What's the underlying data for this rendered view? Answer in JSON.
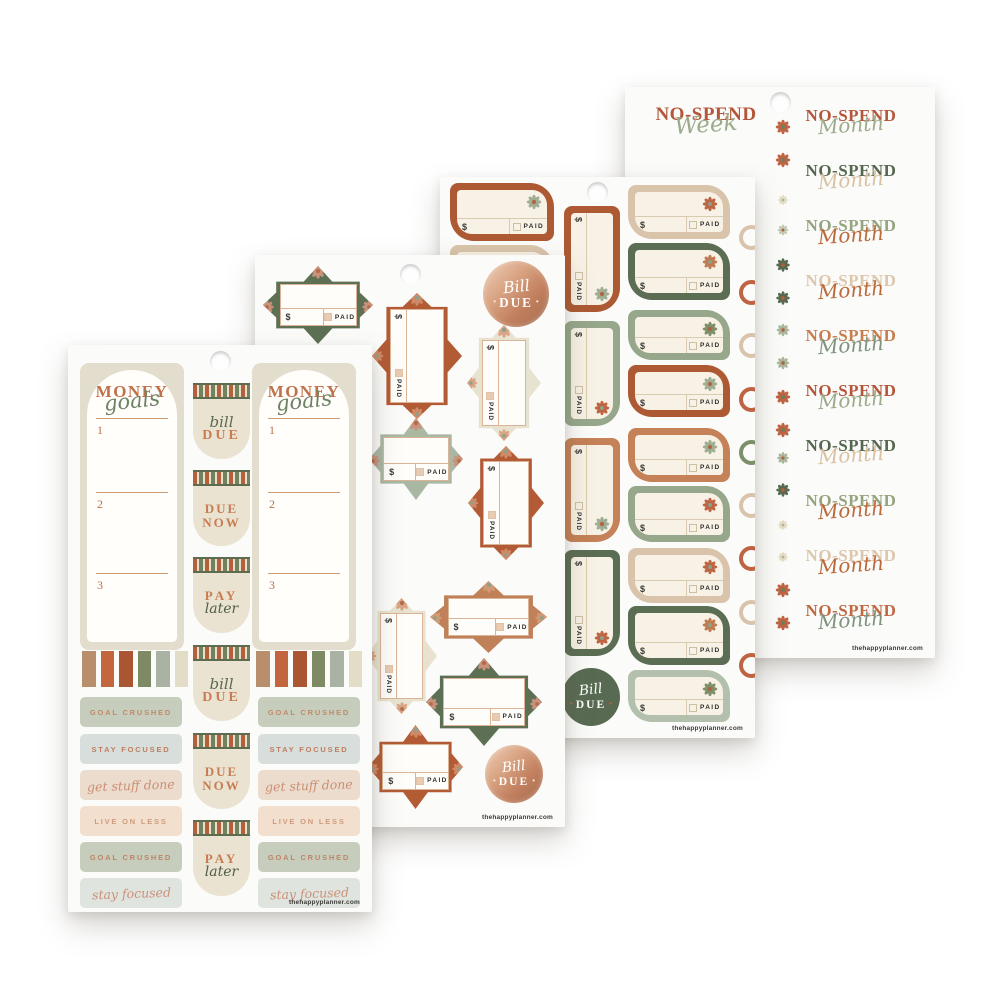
{
  "shared": {
    "website": "thehappyplanner.com",
    "dollar": "$",
    "paid": "PAID",
    "dot": "•"
  },
  "sheet1": {
    "money_sticker": {
      "title": "MONEY",
      "title_script": "goals",
      "sections": [
        "1",
        "2",
        "3"
      ],
      "title_color": "#c0714a",
      "script_color": "#6e8264",
      "num_color": "#bf6f4a"
    },
    "washi_colors": [
      "#b98e6d",
      "#c4663d",
      "#ab5632",
      "#7d8a63",
      "#aab3a3",
      "#e3ddc8"
    ],
    "tabs": [
      {
        "style": "bill-due",
        "line1": "bill",
        "line2": "DUE"
      },
      {
        "style": "due-now",
        "line1": "DUE",
        "line2": "NOW"
      },
      {
        "style": "pay-later",
        "line1": "PAY",
        "line2": "later"
      },
      {
        "style": "bill-due",
        "line1": "bill",
        "line2": "DUE"
      },
      {
        "style": "due-now",
        "line1": "DUE",
        "line2": "NOW"
      },
      {
        "style": "pay-later",
        "line1": "PAY",
        "line2": "later"
      }
    ],
    "tab_colors": {
      "script_green": "#5a6a52",
      "rust": "#c97c52",
      "dark_green": "#4f5d49"
    },
    "labels": [
      {
        "text": "GOAL CRUSHED",
        "bg": "#c7cdbc",
        "color": "#c08a68",
        "script": false
      },
      {
        "text": "STAY FOCUSED",
        "bg": "#d7dedb",
        "color": "#c17d5f",
        "script": false
      },
      {
        "text": "get stuff done",
        "bg": "#ecdccd",
        "color": "#ca8f74",
        "script": true
      },
      {
        "text": "LIVE ON LESS",
        "bg": "#f3dfcd",
        "color": "#cf9b7d",
        "script": false
      },
      {
        "text": "GOAL CRUSHED",
        "bg": "#c7cdbc",
        "color": "#bd8566",
        "script": false
      },
      {
        "text": "stay focused",
        "bg": "#dfe4de",
        "color": "#cb9179",
        "script": true
      }
    ]
  },
  "sheet2": {
    "tags": [
      {
        "type": "h",
        "x": 8,
        "y": 11,
        "w": 110,
        "h": 78,
        "color": "#5d7054",
        "petal": "#c9927a",
        "center": "#b56a4a"
      },
      {
        "type": "v",
        "x": 117,
        "y": 38,
        "w": 90,
        "h": 126,
        "color": "#b25b35",
        "petal": "#cf8a68",
        "center": "#8fa08a"
      },
      {
        "type": "v",
        "x": 212,
        "y": 70,
        "w": 74,
        "h": 116,
        "color": "#e8e2d0",
        "petal": "#d9a585",
        "center": "#8fa08a"
      },
      {
        "type": "h",
        "x": 114,
        "y": 163,
        "w": 94,
        "h": 82,
        "color": "#a9b7a3",
        "petal": "#c9927a",
        "center": "#b56a4a"
      },
      {
        "type": "v",
        "x": 213,
        "y": 191,
        "w": 76,
        "h": 114,
        "color": "#b25b35",
        "petal": "#cf8a68",
        "center": "#8fa08a"
      },
      {
        "type": "h",
        "x": 175,
        "y": 326,
        "w": 117,
        "h": 72,
        "color": "#c08159",
        "petal": "#d19a77",
        "center": "#8fa08a"
      },
      {
        "type": "v",
        "x": 111,
        "y": 343,
        "w": 71,
        "h": 116,
        "color": "#e8e2d0",
        "petal": "#d9a585",
        "center": "#b56a4a"
      },
      {
        "type": "h",
        "x": 171,
        "y": 403,
        "w": 116,
        "h": 88,
        "color": "#5d7054",
        "petal": "#c9927a",
        "center": "#b56a4a"
      },
      {
        "type": "h",
        "x": 113,
        "y": 470,
        "w": 95,
        "h": 84,
        "color": "#b25b35",
        "petal": "#cf8a68",
        "center": "#8fa08a"
      }
    ],
    "circles": [
      {
        "x": 228,
        "y": 6,
        "d": 66
      },
      {
        "x": 230,
        "y": 490,
        "d": 58
      }
    ],
    "circle_text": {
      "script": "Bill",
      "word": "DUE"
    }
  },
  "sheet3": {
    "left_tags": [
      {
        "y": 6,
        "h": 58,
        "color": "#ad5a34",
        "flower": "#9fae93",
        "fcenter": "#b5603c"
      },
      {
        "y": 68,
        "h": 55,
        "color": "#d9c4ab",
        "flower": "#bf6442",
        "fcenter": "#8fa08a"
      }
    ],
    "mid_tags": [
      {
        "y": 29,
        "h": 106,
        "color": "#ad5a34",
        "flower": "#9fae93",
        "fcenter": "#b5603c"
      },
      {
        "y": 144,
        "h": 105,
        "color": "#97a78b",
        "flower": "#bf6442",
        "fcenter": "#8fa08a"
      },
      {
        "y": 261,
        "h": 104,
        "color": "#c58157",
        "flower": "#9fae93",
        "fcenter": "#b5603c"
      },
      {
        "y": 373,
        "h": 106,
        "color": "#5b6d53",
        "flower": "#bf6442",
        "fcenter": "#8fa08a"
      }
    ],
    "right_tags": [
      {
        "y": 8,
        "h": 54,
        "color": "#d9c4ab",
        "flower": "#bf6442",
        "fcenter": "#8fa08a"
      },
      {
        "y": 66,
        "h": 57,
        "color": "#5b6d53",
        "flower": "#c07a50",
        "fcenter": "#8fa08a"
      },
      {
        "y": 133,
        "h": 50,
        "color": "#97a78b",
        "flower": "#7d8f68",
        "fcenter": "#b5603c"
      },
      {
        "y": 188,
        "h": 52,
        "color": "#ad5a34",
        "flower": "#9fae93",
        "fcenter": "#b5603c"
      },
      {
        "y": 251,
        "h": 54,
        "color": "#c58157",
        "flower": "#9fae93",
        "fcenter": "#b5603c"
      },
      {
        "y": 309,
        "h": 56,
        "color": "#97a78b",
        "flower": "#bf6442",
        "fcenter": "#8fa08a"
      },
      {
        "y": 371,
        "h": 55,
        "color": "#d9c4ab",
        "flower": "#bf6442",
        "fcenter": "#8fa08a"
      },
      {
        "y": 429,
        "h": 59,
        "color": "#5b6d53",
        "flower": "#c07a50",
        "fcenter": "#8fa08a"
      },
      {
        "y": 493,
        "h": 52,
        "color": "#b3c0ad",
        "flower": "#7d8f68",
        "fcenter": "#b5603c"
      }
    ],
    "rings": [
      {
        "y": 48,
        "color": "#d9c4ab"
      },
      {
        "y": 103,
        "color": "#bf6442"
      },
      {
        "y": 156,
        "color": "#d9c4ab"
      },
      {
        "y": 210,
        "color": "#bf6442"
      },
      {
        "y": 263,
        "color": "#7d8f68"
      },
      {
        "y": 316,
        "color": "#d9c4ab"
      },
      {
        "y": 369,
        "color": "#bf6442"
      },
      {
        "y": 423,
        "color": "#d9c4ab"
      },
      {
        "y": 476,
        "color": "#bf6442"
      }
    ],
    "circle": {
      "x": 122,
      "y": 491,
      "d": 58
    },
    "circle_text": {
      "script": "Bill",
      "word": "DUE"
    }
  },
  "sheet4": {
    "week_row": {
      "word": "NO-SPEND",
      "script": "Week",
      "word_color": "#b5563b",
      "script_color": "#9cab8b"
    },
    "rows": [
      {
        "word": "NO-SPEND",
        "script": "Month",
        "word_color": "#b5563b",
        "script_color": "#9cab8b"
      },
      {
        "word": "NO-SPEND",
        "script": "Month",
        "word_color": "#55684f",
        "script_color": "#d9c2a4"
      },
      {
        "word": "NO-SPEND",
        "script": "Month",
        "word_color": "#95a47f",
        "script_color": "#bc6a3b"
      },
      {
        "word": "NO-SPEND",
        "script": "Month",
        "word_color": "#dcc7ad",
        "script_color": "#bc6a3b"
      },
      {
        "word": "NO-SPEND",
        "script": "Month",
        "word_color": "#c87d4e",
        "script_color": "#7f947f"
      },
      {
        "word": "NO-SPEND",
        "script": "Month",
        "word_color": "#b5563b",
        "script_color": "#9cab8b"
      },
      {
        "word": "NO-SPEND",
        "script": "Month",
        "word_color": "#55684f",
        "script_color": "#d9c2a4"
      },
      {
        "word": "NO-SPEND",
        "script": "Month",
        "word_color": "#95a47f",
        "script_color": "#bc6a3b"
      },
      {
        "word": "NO-SPEND",
        "script": "Month",
        "word_color": "#dcc7ad",
        "script_color": "#bc6a3b"
      },
      {
        "word": "NO-SPEND",
        "script": "Month",
        "word_color": "#c06a44",
        "script_color": "#7f947f"
      }
    ],
    "flowers": [
      {
        "y": 40,
        "c": "#bf6442",
        "center": "#6f7f5e",
        "s": 15
      },
      {
        "y": 73,
        "c": "#bf6442",
        "center": "#6f7f5e",
        "s": 15
      },
      {
        "y": 113,
        "c": "#e4ddc2",
        "center": "#a9b499",
        "s": 10
      },
      {
        "y": 143,
        "c": "#c2cbb4",
        "center": "#b5603c",
        "s": 11
      },
      {
        "y": 178,
        "c": "#586b52",
        "center": "#b5603c",
        "s": 14
      },
      {
        "y": 211,
        "c": "#586b52",
        "center": "#b5603c",
        "s": 14
      },
      {
        "y": 243,
        "c": "#a9b79c",
        "center": "#b5603c",
        "s": 13
      },
      {
        "y": 276,
        "c": "#a9b79c",
        "center": "#b5603c",
        "s": 13
      },
      {
        "y": 310,
        "c": "#bf6442",
        "center": "#6f7f5e",
        "s": 15
      },
      {
        "y": 343,
        "c": "#bf6442",
        "center": "#6f7f5e",
        "s": 15
      },
      {
        "y": 371,
        "c": "#a9b79c",
        "center": "#b5603c",
        "s": 12
      },
      {
        "y": 403,
        "c": "#586b52",
        "center": "#b5603c",
        "s": 14
      },
      {
        "y": 438,
        "c": "#e4ddc2",
        "center": "#a9b499",
        "s": 10
      },
      {
        "y": 470,
        "c": "#e4ddc2",
        "center": "#a9b499",
        "s": 10
      },
      {
        "y": 503,
        "c": "#bf6442",
        "center": "#6f7f5e",
        "s": 15
      },
      {
        "y": 536,
        "c": "#bf6442",
        "center": "#6f7f5e",
        "s": 15
      }
    ]
  }
}
